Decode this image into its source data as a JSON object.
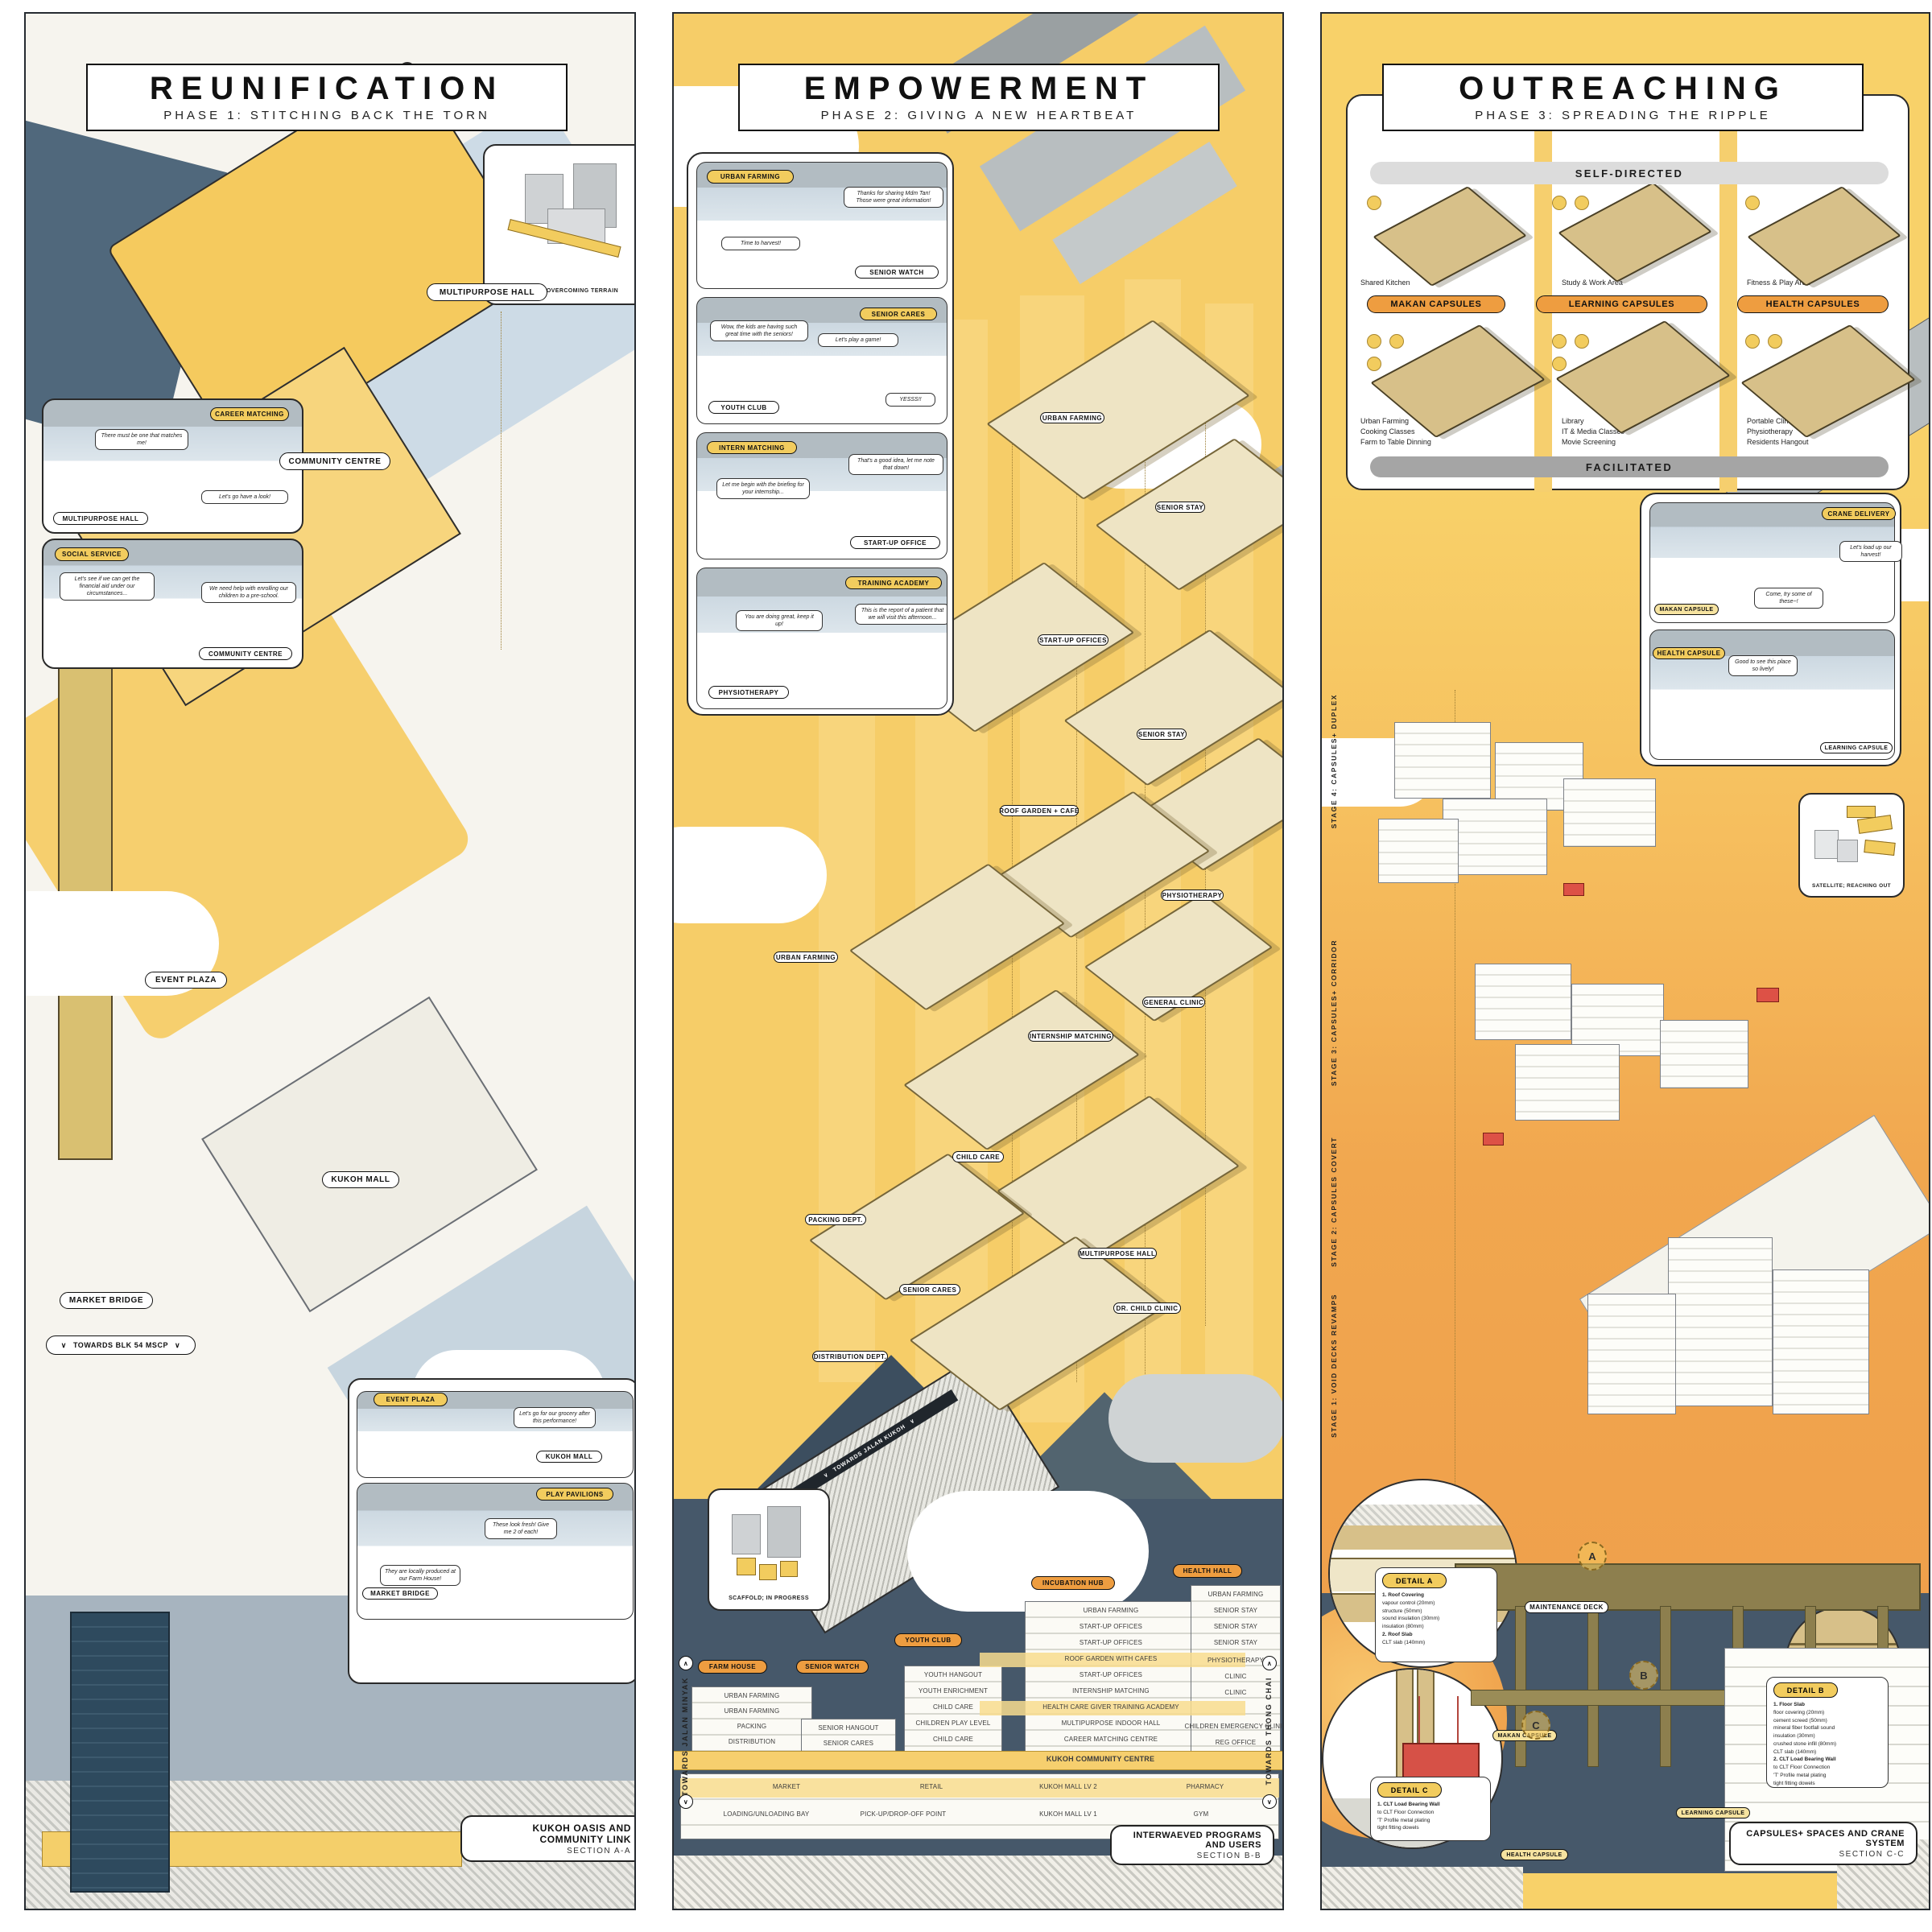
{
  "colors": {
    "accent_yellow": "#f2cc5e",
    "accent_orange": "#ee9d40",
    "slate": "#46586a",
    "panel_yellow": "#f6cd68"
  },
  "icons": {
    "chevron_down": "∨",
    "chevron_up": "∧"
  },
  "p1": {
    "title": "REUNIFICATION",
    "subtitle": "PHASE 1: STITCHING BACK THE TORN",
    "bridge_caption": "BRIDGE; OVERCOMING TERRAIN",
    "labels": {
      "multipurpose_hall": "MULTIPURPOSE HALL",
      "community_centre": "COMMUNITY CENTRE",
      "event_plaza": "EVENT PLAZA",
      "kukoh_mall": "KUKOH MALL",
      "market_bridge": "MARKET BRIDGE",
      "towards_mscp": "TOWARDS BLK 54 MSCP"
    },
    "career": {
      "tag": "CAREER MATCHING",
      "bubble1": "There must be one that matches me!",
      "bubble2": "Let's go have a look!",
      "room": "MULTIPURPOSE HALL"
    },
    "social": {
      "tag": "SOCIAL SERVICE",
      "bubble1": "Let's see if we can get the financial aid under our circumstances...",
      "bubble2": "We need help with enrolling our children to a pre-school.",
      "room": "COMMUNITY CENTRE"
    },
    "plaza": {
      "tag1": "EVENT PLAZA",
      "bubble1": "Let's go for our grocery after this performance!",
      "room1": "KUKOH MALL",
      "tag2": "PLAY PAVILIONS",
      "bubble2": "These look fresh! Give me 2 of each!",
      "bubble3": "They are locally produced at our Farm House!",
      "room2": "MARKET BRIDGE"
    },
    "section": {
      "title": "KUKOH OASIS AND COMMUNITY LINK",
      "sub": "SECTION A-A"
    }
  },
  "p2": {
    "title": "EMPOWERMENT",
    "subtitle": "PHASE 2: GIVING A NEW HEARTBEAT",
    "v1": {
      "tag": "URBAN FARMING",
      "bubble1": "Time to harvest!",
      "bubble2": "Thanks for sharing Mdm Tan! Those were great information!",
      "room": "SENIOR WATCH"
    },
    "v2": {
      "tag": "SENIOR CARES",
      "bubble1": "Wow, the kids are having such great time with the seniors!",
      "bubble2": "Let's play a game!",
      "bubble3": "YESSS!!",
      "room": "YOUTH CLUB"
    },
    "v3": {
      "tag": "INTERN MATCHING",
      "bubble1": "Let me begin with the briefing for your internship...",
      "bubble2": "That's a good idea, let me note that down!",
      "room": "START-UP OFFICE"
    },
    "v4": {
      "tag": "TRAINING ACADEMY",
      "bubble1": "You are doing great, keep it up!",
      "bubble2": "This is the report of a patient that we will visit this afternoon...",
      "room": "PHYSIOTHERAPY"
    },
    "axon": [
      "URBAN FARMING",
      "SENIOR STAY",
      "START-UP OFFICES",
      "ROOF GARDEN + CAFE",
      "SENIOR STAY",
      "PHYSIOTHERAPY",
      "URBAN FARMING",
      "GENERAL CLINIC",
      "INTERNSHIP MATCHING",
      "CHILD CARE",
      "PACKING DEPT.",
      "SENIOR CARES",
      "MULTIPURPOSE HALL",
      "DR. CHILD CLINIC",
      "DISTRIBUTION DEPT."
    ],
    "scaffold_caption": "SCAFFOLD; IN PROGRESS",
    "ramp_label": "TOWARDS JALAN KUKOH",
    "towards_left": "TOWARDS JALAN MINYAK",
    "towards_right": "TOWARDS THONG CHAI",
    "pills": [
      "FARM HOUSE",
      "SENIOR WATCH",
      "YOUTH CLUB",
      "INCUBATION HUB",
      "HEALTH HALL"
    ],
    "t1": [
      "URBAN FARMING",
      "URBAN FARMING",
      "PACKING",
      "DISTRIBUTION"
    ],
    "t2": [
      "SENIOR HANGOUT",
      "SENIOR CARES"
    ],
    "t3": [
      "YOUTH HANGOUT",
      "YOUTH ENRICHMENT",
      "CHILD CARE",
      "CHILDREN PLAY LEVEL",
      "CHILD CARE"
    ],
    "t4": [
      "URBAN FARMING",
      "START-UP OFFICES",
      "START-UP OFFICES",
      "ROOF GARDEN WITH CAFES",
      "START-UP OFFICES",
      "INTERNSHIP MATCHING",
      "HEALTH CARE GIVER TRAINING ACADEMY",
      "MULTIPURPOSE INDOOR HALL",
      "CAREER MATCHING CENTRE"
    ],
    "band": "KUKOH COMMUNITY CENTRE",
    "t5": [
      "URBAN FARMING",
      "SENIOR STAY",
      "SENIOR STAY",
      "SENIOR STAY",
      "PHYSIOTHERAPY",
      "CLINIC",
      "CLINIC",
      "CHILDREN EMERGENCY CLINIC",
      "REG OFFICE"
    ],
    "mall1": [
      "MARKET",
      "RETAIL",
      "KUKOH MALL LV 2",
      "PHARMACY"
    ],
    "mall2": [
      "LOADING/UNLOADING BAY",
      "PICK-UP/DROP-OFF POINT",
      "KUKOH MALL LV 1",
      "GYM"
    ],
    "section": {
      "title": "INTERWAEVED PROGRAMS AND USERS",
      "sub": "SECTION B-B"
    }
  },
  "p3": {
    "title": "OUTREACHING",
    "subtitle": "PHASE 3: SPREADING THE RIPPLE",
    "self_directed": "SELF-DIRECTED",
    "facilitated": "FACILITATED",
    "cols": [
      {
        "pill": "MAKAN CAPSULES",
        "top": "Shared Kitchen",
        "b1": "Urban Farming",
        "b2": "Cooking Classes",
        "b3": "Farm to Table Dinning"
      },
      {
        "pill": "LEARNING CAPSULES",
        "top": "Study & Work Area",
        "b1": "Library",
        "b2": "IT & Media Classes",
        "b3": "Movie Screening"
      },
      {
        "pill": "HEALTH CAPSULES",
        "top": "Fitness & Play Area",
        "b1": "Portable Clinic",
        "b2": "Physiotherapy",
        "b3": "Residents Hangout"
      }
    ],
    "crane": {
      "tag": "CRANE DELIVERY",
      "bubble1": "Let's load up our harvest!",
      "bubble2": "Come, try some of these~!",
      "room": "MAKAN CAPSULE"
    },
    "learn": {
      "tag": "HEALTH CAPSULE",
      "bubble1": "Good to see this place so lively!",
      "room": "LEARNING CAPSULE"
    },
    "satellite_caption": "SATELLITE; REACHING OUT",
    "stages": [
      "STAGE 4: CAPSULES+ DUPLEX",
      "STAGE 3: CAPSULES+ CORRIDOR",
      "STAGE 2: CAPSULES COVERT",
      "STAGE 1: VOID DECKS REVAMPS"
    ],
    "blk": "BLK 2",
    "maintenance": "MAINTENANCE DECK",
    "markers": [
      "A",
      "B",
      "C"
    ],
    "detail_a": {
      "tag": "DETAIL A",
      "lines": [
        "1. Roof Covering",
        "vapour control (20mm)",
        "structure (50mm)",
        "sound insulation (30mm)",
        "insulation (80mm)",
        "2. Roof Slab",
        "CLT slab (140mm)"
      ]
    },
    "detail_b": {
      "tag": "DETAIL B",
      "lines": [
        "1. Floor Slab",
        "floor covering (20mm)",
        "cement screed (50mm)",
        "mineral fiber footfall sound",
        "insulation (30mm)",
        "crushed stone infill (80mm)",
        "CLT slab (140mm)",
        "2. CLT Load Bearing Wall",
        "to CLT Floor Connection",
        "'T' Profile metal plating",
        "tight fitting dowels"
      ]
    },
    "detail_c": {
      "tag": "DETAIL C",
      "lines": [
        "1. CLT Load Bearing Wall",
        "to CLT Floor Connection",
        "'T' Profile metal plating",
        "tight fitting dowels"
      ]
    },
    "caps": {
      "makan": "MAKAN CAPSULE",
      "learning": "LEARNING CAPSULE",
      "health": "HEALTH CAPSULE"
    },
    "section": {
      "title": "CAPSULES+ SPACES AND CRANE SYSTEM",
      "sub": "SECTION C-C"
    }
  }
}
